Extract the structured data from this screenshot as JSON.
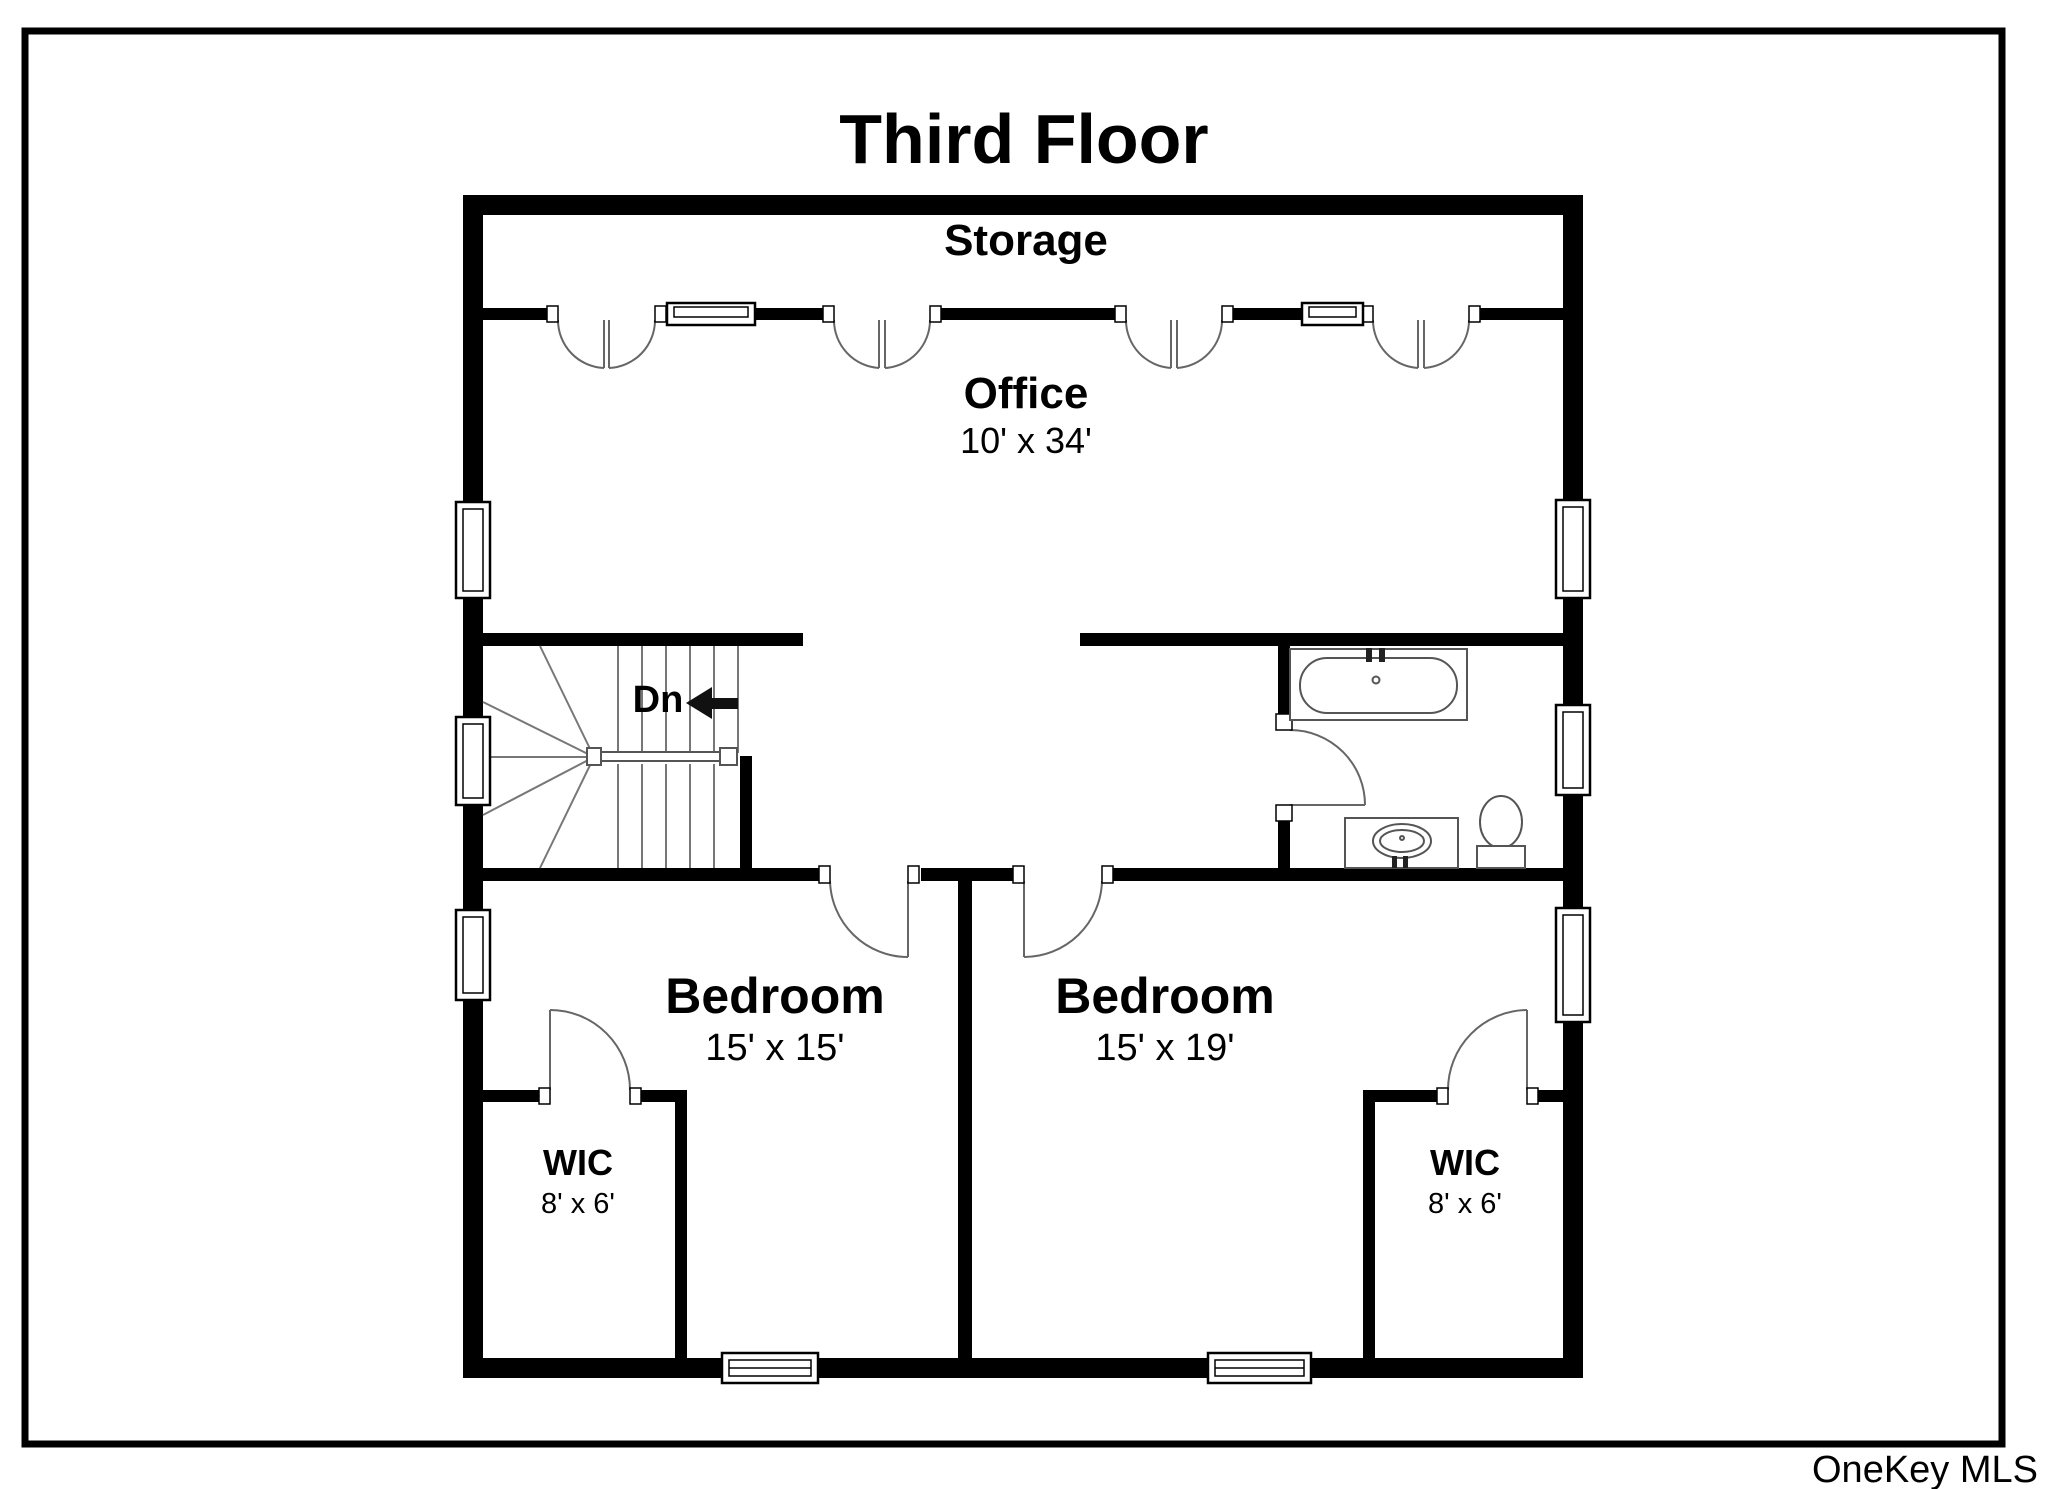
{
  "title": "Third Floor",
  "watermark": "OneKey MLS",
  "rooms": {
    "storage": {
      "label": "Storage"
    },
    "office": {
      "label": "Office",
      "dims": "10' x 34'"
    },
    "bedroom_left": {
      "label": "Bedroom",
      "dims": "15' x 15'"
    },
    "bedroom_right": {
      "label": "Bedroom",
      "dims": "15' x 19'"
    },
    "wic_left": {
      "label": "WIC",
      "dims": "8' x 6'"
    },
    "wic_right": {
      "label": "WIC",
      "dims": "8' x 6'"
    }
  },
  "stairs": {
    "direction_label": "Dn"
  },
  "colors": {
    "wall": "#000000",
    "background": "#ffffff",
    "stair_line": "#777777",
    "fixture_line": "#555555",
    "door_line": "#666666",
    "watermark": "#b8b8b8"
  }
}
